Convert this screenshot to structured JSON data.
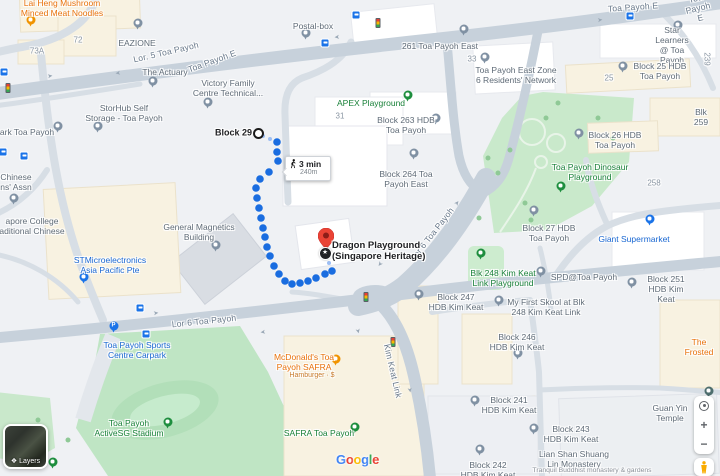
{
  "app": {
    "name": "Google Maps walking directions"
  },
  "route": {
    "duration": "3 min",
    "distance": "240m",
    "origin_label": "Block 29",
    "destination_label": "Dragon Playground\n(Singapore Heritage)"
  },
  "controls": {
    "layers_label": "Layers",
    "zoom_in": "+",
    "zoom_out": "−",
    "star_glyph": "★"
  },
  "google_logo": {
    "letters": [
      {
        "ch": "G",
        "color": "#4285F4"
      },
      {
        "ch": "o",
        "color": "#EA4335"
      },
      {
        "ch": "o",
        "color": "#FBBC04"
      },
      {
        "ch": "g",
        "color": "#4285F4"
      },
      {
        "ch": "l",
        "color": "#34A853"
      },
      {
        "ch": "e",
        "color": "#EA4335"
      }
    ]
  },
  "map": {
    "colors": {
      "route_blue": "#1a6de0",
      "route_dash": "#9dbef3",
      "park_green": "#c5e8c9",
      "road": "#c7d1db"
    },
    "poi_labels": [
      {
        "name": "lai-heng",
        "text": "Lai Heng Mushroom\nMinced Meat Noodles",
        "x": 62,
        "y": 8,
        "kind": "orange"
      },
      {
        "name": "eazione",
        "text": "EAZIONE",
        "x": 137,
        "y": 43
      },
      {
        "name": "postal-box",
        "text": "Postal-box",
        "x": 313,
        "y": 26
      },
      {
        "name": "the-actuary",
        "text": "The Actuary",
        "x": 165,
        "y": 72
      },
      {
        "name": "victory-family",
        "text": "Victory Family\nCentre Technical...",
        "x": 228,
        "y": 88
      },
      {
        "name": "storhub",
        "text": "StorHub Self\nStorage - Toa Payoh",
        "x": 124,
        "y": 113
      },
      {
        "name": "261-toa-payoh-east",
        "text": "261 Toa Payoh East",
        "x": 440,
        "y": 46
      },
      {
        "name": "block-263",
        "text": "Block 263 HDB\nToa Payoh",
        "x": 406,
        "y": 125
      },
      {
        "name": "block-264",
        "text": "Block 264 Toa\nPayoh East",
        "x": 406,
        "y": 179
      },
      {
        "name": "apex-playground",
        "text": "APEX Playground",
        "x": 371,
        "y": 103,
        "kind": "green"
      },
      {
        "name": "tp-east-zone6",
        "text": "Toa Payoh East Zone\n6 Residents' Network",
        "x": 516,
        "y": 75
      },
      {
        "name": "star-learners",
        "text": "Star Learners\n@ Toa Payoh",
        "x": 672,
        "y": 45
      },
      {
        "name": "block-25",
        "text": "Block 25 HDB\nToa Payoh",
        "x": 660,
        "y": 71
      },
      {
        "name": "blk-259",
        "text": "Blk 259",
        "x": 701,
        "y": 117
      },
      {
        "name": "block-26",
        "text": "Block 26 HDB\nToa Payoh",
        "x": 615,
        "y": 140
      },
      {
        "name": "dinosaur-playground",
        "text": "Toa Payoh Dinosaur\nPlayground",
        "x": 590,
        "y": 172,
        "kind": "green"
      },
      {
        "name": "block-27",
        "text": "Block 27 HDB\nToa Payoh",
        "x": 549,
        "y": 233
      },
      {
        "name": "giant-supermarket",
        "text": "Giant Supermarket",
        "x": 634,
        "y": 239,
        "kind": "blue"
      },
      {
        "name": "blk-248-playground",
        "text": "Blk 248 Kim Keat\nLink Playground",
        "x": 503,
        "y": 278,
        "kind": "green"
      },
      {
        "name": "spd-toa-payoh",
        "text": "SPD@Toa Payoh",
        "x": 584,
        "y": 277
      },
      {
        "name": "block-251",
        "text": "Block 251\nHDB Kim Keat",
        "x": 666,
        "y": 289
      },
      {
        "name": "block-247",
        "text": "Block 247\nHDB Kim Keat",
        "x": 456,
        "y": 302
      },
      {
        "name": "my-first-skool",
        "text": "My First Skool at Blk\n248 Kim Keat Link",
        "x": 546,
        "y": 307
      },
      {
        "name": "block-246",
        "text": "Block 246\nHDB Kim Keat",
        "x": 517,
        "y": 342
      },
      {
        "name": "the-frosted",
        "text": "The Frosted",
        "x": 699,
        "y": 347,
        "kind": "orange"
      },
      {
        "name": "guan-yin-temple",
        "text": "Guan Yin Temple",
        "x": 670,
        "y": 413
      },
      {
        "name": "block-241",
        "text": "Block 241\nHDB Kim Keat",
        "x": 509,
        "y": 405
      },
      {
        "name": "block-243",
        "text": "Block 243\nHDB Kim Keat",
        "x": 571,
        "y": 434
      },
      {
        "name": "block-242",
        "text": "Block 242\nHDB Kim Keat",
        "x": 488,
        "y": 470
      },
      {
        "name": "lian-shan-monastery",
        "text": "Lian Shan Shuang\nLin Monastery",
        "x": 574,
        "y": 459
      },
      {
        "name": "lian-shan-subtitle",
        "text": "Tranquil Buddhist monastery & gardens",
        "x": 592,
        "y": 471,
        "kind": "sub"
      },
      {
        "name": "mcdonalds",
        "text": "McDonald's Toa\nPayoh SAFRA",
        "x": 304,
        "y": 362,
        "kind": "orange"
      },
      {
        "name": "mcdonalds-subtitle",
        "text": "Hamburger · $",
        "x": 312,
        "y": 376,
        "kind": "orange-sub"
      },
      {
        "name": "safra-toa-payoh",
        "text": "SAFRA Toa Payoh",
        "x": 319,
        "y": 433,
        "kind": "green"
      },
      {
        "name": "sports-centre-carpark",
        "text": "Toa Payoh Sports\nCentre Carpark",
        "x": 137,
        "y": 350,
        "kind": "blue"
      },
      {
        "name": "activesg-stadium",
        "text": "Toa Payoh\nActiveSG Stadium",
        "x": 129,
        "y": 428,
        "kind": "green"
      },
      {
        "name": "ark-toa-payoh",
        "text": "ark Toa Payoh",
        "x": 27,
        "y": 132
      },
      {
        "name": "chinese-assn",
        "text": "Chinese\nns' Assn",
        "x": 16,
        "y": 182
      },
      {
        "name": "college-tcm",
        "text": "apore College\naditional Chinese",
        "x": 32,
        "y": 226
      },
      {
        "name": "general-magnetics",
        "text": "General Magnetics\nBuilding",
        "x": 199,
        "y": 232
      },
      {
        "name": "stmicroelectronics",
        "text": "STMicroelectronics\nAsia Pacific Pte",
        "x": 110,
        "y": 265,
        "kind": "blue"
      }
    ],
    "road_labels": [
      {
        "text": "Lor. 5 Toa Payoh",
        "x": 166,
        "y": 52,
        "rot": -13
      },
      {
        "text": "Toa Payoh E",
        "x": 212,
        "y": 61,
        "rot": -20
      },
      {
        "text": "Toa Payoh E",
        "x": 633,
        "y": 7,
        "rot": -4
      },
      {
        "text": "Toa Payoh E",
        "x": 698,
        "y": 8,
        "rot": -14
      },
      {
        "text": "Lor 6 Toa Payoh",
        "x": 204,
        "y": 321,
        "rot": -6
      },
      {
        "text": "Lor 6 Toa Payoh",
        "x": 432,
        "y": 234,
        "rot": -52
      },
      {
        "text": "Kim Keat Link",
        "x": 393,
        "y": 371,
        "rot": 77
      }
    ],
    "numbers": [
      {
        "text": "72",
        "x": 78,
        "y": 40
      },
      {
        "text": "73A",
        "x": 37,
        "y": 51
      },
      {
        "text": "31",
        "x": 340,
        "y": 116
      },
      {
        "text": "25",
        "x": 609,
        "y": 78
      },
      {
        "text": "258",
        "x": 654,
        "y": 183
      },
      {
        "text": "33",
        "x": 472,
        "y": 59
      },
      {
        "text": "239",
        "x": 707,
        "y": 59,
        "rot": 90
      }
    ],
    "pins": [
      {
        "name": "lai-heng",
        "x": 35,
        "y": 24,
        "color": "orange"
      },
      {
        "name": "eazione",
        "x": 142,
        "y": 27,
        "color": "gray"
      },
      {
        "name": "postal-box",
        "x": 310,
        "y": 37,
        "color": "gray"
      },
      {
        "name": "the-actuary",
        "x": 157,
        "y": 85,
        "color": "gray"
      },
      {
        "name": "victory-family",
        "x": 212,
        "y": 106,
        "color": "gray"
      },
      {
        "name": "storhub",
        "x": 102,
        "y": 130,
        "color": "gray"
      },
      {
        "name": "261-toa-payoh-east",
        "x": 468,
        "y": 33,
        "color": "gray"
      },
      {
        "name": "block-263",
        "x": 440,
        "y": 122,
        "color": "gray"
      },
      {
        "name": "block-264",
        "x": 418,
        "y": 157,
        "color": "gray"
      },
      {
        "name": "apex-playground",
        "x": 412,
        "y": 99,
        "color": "green"
      },
      {
        "name": "tp-east-zone6",
        "x": 489,
        "y": 61,
        "color": "gray"
      },
      {
        "name": "star-learners",
        "x": 682,
        "y": 29,
        "color": "gray"
      },
      {
        "name": "block-25",
        "x": 627,
        "y": 70,
        "color": "gray"
      },
      {
        "name": "block-26",
        "x": 583,
        "y": 137,
        "color": "gray"
      },
      {
        "name": "dinosaur-playground",
        "x": 565,
        "y": 190,
        "color": "green"
      },
      {
        "name": "block-27",
        "x": 538,
        "y": 214,
        "color": "gray"
      },
      {
        "name": "giant-supermarket",
        "x": 654,
        "y": 223,
        "color": "blue"
      },
      {
        "name": "blk-248-playground",
        "x": 485,
        "y": 257,
        "color": "green"
      },
      {
        "name": "spd-toa-payoh",
        "x": 545,
        "y": 275,
        "color": "gray"
      },
      {
        "name": "block-251",
        "x": 636,
        "y": 286,
        "color": "gray"
      },
      {
        "name": "block-247",
        "x": 423,
        "y": 298,
        "color": "gray"
      },
      {
        "name": "my-first-skool",
        "x": 503,
        "y": 304,
        "color": "gray"
      },
      {
        "name": "block-246",
        "x": 522,
        "y": 357,
        "color": "gray"
      },
      {
        "name": "block-241",
        "x": 479,
        "y": 404,
        "color": "gray"
      },
      {
        "name": "block-243",
        "x": 538,
        "y": 432,
        "color": "gray"
      },
      {
        "name": "block-242",
        "x": 484,
        "y": 453,
        "color": "gray"
      },
      {
        "name": "mcdonalds",
        "x": 340,
        "y": 363,
        "color": "orange"
      },
      {
        "name": "safra-toa-payoh",
        "x": 359,
        "y": 431,
        "color": "green"
      },
      {
        "name": "sports-centre-carpark",
        "x": 118,
        "y": 330,
        "color": "blue",
        "glyph": "P"
      },
      {
        "name": "activesg-stadium",
        "x": 172,
        "y": 426,
        "color": "green"
      },
      {
        "name": "ark-toa-payoh",
        "x": 62,
        "y": 130,
        "color": "gray"
      },
      {
        "name": "chinese-assn",
        "x": 18,
        "y": 202,
        "color": "gray"
      },
      {
        "name": "general-magnetics",
        "x": 220,
        "y": 249,
        "color": "gray"
      },
      {
        "name": "stmicroelectronics",
        "x": 88,
        "y": 281,
        "color": "blue"
      },
      {
        "name": "guan-yin-temple",
        "x": 713,
        "y": 395,
        "color": "dark"
      },
      {
        "name": "park-south",
        "x": 57,
        "y": 466,
        "color": "green"
      }
    ],
    "bus_stops": [
      [
        4,
        72
      ],
      [
        325,
        43
      ],
      [
        356,
        15
      ],
      [
        630,
        16
      ],
      [
        140,
        308
      ],
      [
        146,
        334
      ],
      [
        3,
        152
      ],
      [
        24,
        156
      ]
    ],
    "traffic_lights": [
      [
        378,
        23
      ],
      [
        366,
        297
      ],
      [
        393,
        342
      ],
      [
        8,
        88
      ]
    ],
    "arrows": [
      {
        "x": 50,
        "y": 76,
        "rot": -8
      },
      {
        "x": 118,
        "y": 73,
        "rot": 172
      },
      {
        "x": 337,
        "y": 37,
        "rot": 175
      },
      {
        "x": 156,
        "y": 313,
        "rot": -7
      },
      {
        "x": 263,
        "y": 332,
        "rot": 172
      },
      {
        "x": 457,
        "y": 203,
        "rot": -52
      },
      {
        "x": 380,
        "y": 264,
        "rot": 128
      },
      {
        "x": 358,
        "y": 331,
        "rot": 77
      },
      {
        "x": 600,
        "y": 20,
        "rot": -6
      },
      {
        "x": 410,
        "y": 390,
        "rot": 80
      }
    ],
    "trees": [
      [
        490,
        160
      ],
      [
        500,
        175
      ],
      [
        512,
        152
      ],
      [
        527,
        205
      ],
      [
        548,
        120
      ],
      [
        560,
        105
      ],
      [
        600,
        120
      ],
      [
        615,
        140
      ],
      [
        481,
        220
      ],
      [
        533,
        222
      ],
      [
        70,
        442
      ],
      [
        40,
        422
      ]
    ],
    "route_dots": [
      [
        277,
        142
      ],
      [
        277,
        152
      ],
      [
        278,
        161
      ],
      [
        269,
        172
      ],
      [
        260,
        179
      ],
      [
        256,
        188
      ],
      [
        257,
        198
      ],
      [
        259,
        208
      ],
      [
        261,
        218
      ],
      [
        263,
        228
      ],
      [
        265,
        237
      ],
      [
        267,
        247
      ],
      [
        270,
        256
      ],
      [
        274,
        266
      ],
      [
        279,
        274
      ],
      [
        285,
        281
      ],
      [
        292,
        284
      ],
      [
        300,
        283
      ],
      [
        308,
        281
      ],
      [
        316,
        278
      ],
      [
        325,
        274
      ],
      [
        332,
        271
      ]
    ],
    "route_dashes": [
      [
        263,
        136
      ],
      [
        270,
        139
      ],
      [
        329,
        263
      ],
      [
        326,
        257
      ]
    ]
  }
}
